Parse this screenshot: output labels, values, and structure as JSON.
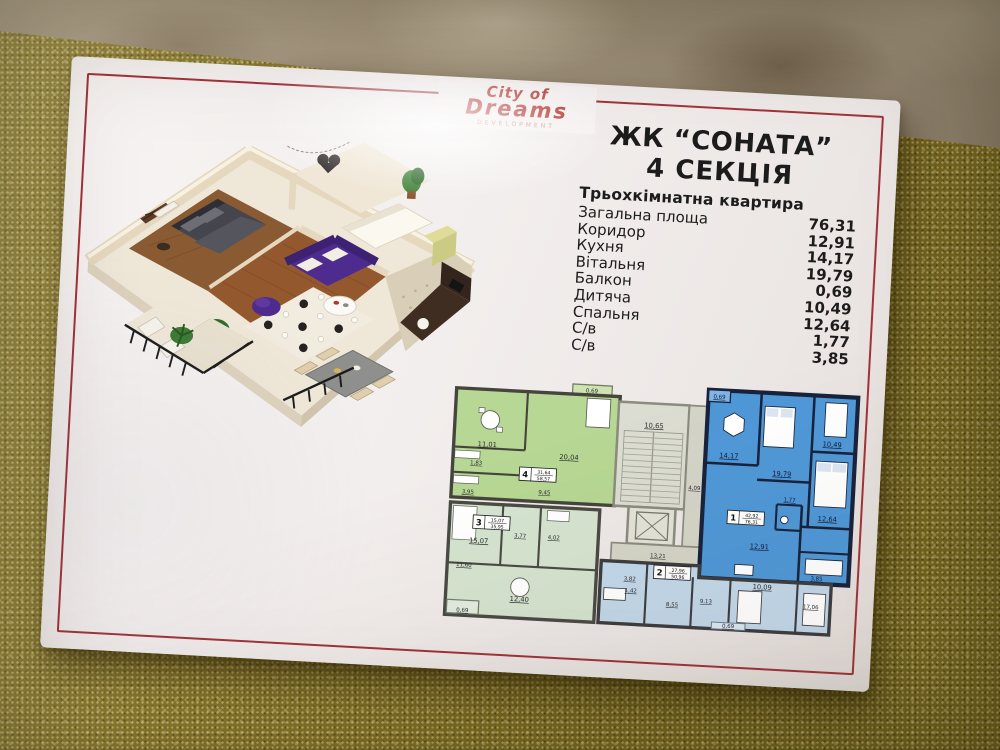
{
  "brand": {
    "line1": "City of",
    "line2": "Dreams",
    "tagline": "DEVELOPMENT"
  },
  "header": {
    "title": "ЖК “СОНАТА”",
    "subtitle": "4 СЕКЦІЯ",
    "apartment_type": "Трьохкімнатна квартира"
  },
  "rooms": [
    {
      "label": "Загальна площа",
      "value": "76,31"
    },
    {
      "label": "Коридор",
      "value": "12,91"
    },
    {
      "label": "Кухня",
      "value": "14,17"
    },
    {
      "label": "Вітальня",
      "value": "19,79"
    },
    {
      "label": "Балкон",
      "value": "0,69"
    },
    {
      "label": "Дитяча",
      "value": "10,49"
    },
    {
      "label": "Спальня",
      "value": "12,64"
    },
    {
      "label": "С/в",
      "value": "1,77"
    },
    {
      "label": "С/в",
      "value": "3,85"
    }
  ],
  "floor_plan": {
    "apartments": [
      {
        "number": "4",
        "area_living": "31,64",
        "area_total": "58,57"
      },
      {
        "number": "1",
        "area_living": "42,92",
        "area_total": "76,31"
      },
      {
        "number": "3",
        "area_living": "15,07",
        "area_total": "35,95"
      },
      {
        "number": "2",
        "area_living": "27,96",
        "area_total": "50,96"
      }
    ],
    "dims": [
      "0,69",
      "10,65",
      "4,09",
      "11,01",
      "1,83",
      "3,95",
      "20,04",
      "9,45",
      "0,69",
      "10,49",
      "12,64",
      "14,17",
      "19,79",
      "1,77",
      "12,91",
      "3,85",
      "13,21",
      "15,07",
      "3,77",
      "4,02",
      "12,40",
      "11,60",
      "0,69",
      "3,82",
      "1,42",
      "8,55",
      "9,13",
      "10,09",
      "17,06",
      "0,69"
    ]
  },
  "colors": {
    "accent_red": "#a2333a",
    "logo_red": "#b5342f",
    "apartment1_blue": "#4f98d8",
    "apartment2_blue": "#c2d8ea",
    "apartment3_green": "#d5e4d0",
    "apartment4_green": "#b7d794",
    "gold_cloth": "#877627",
    "paper_white": "#f3efee"
  }
}
